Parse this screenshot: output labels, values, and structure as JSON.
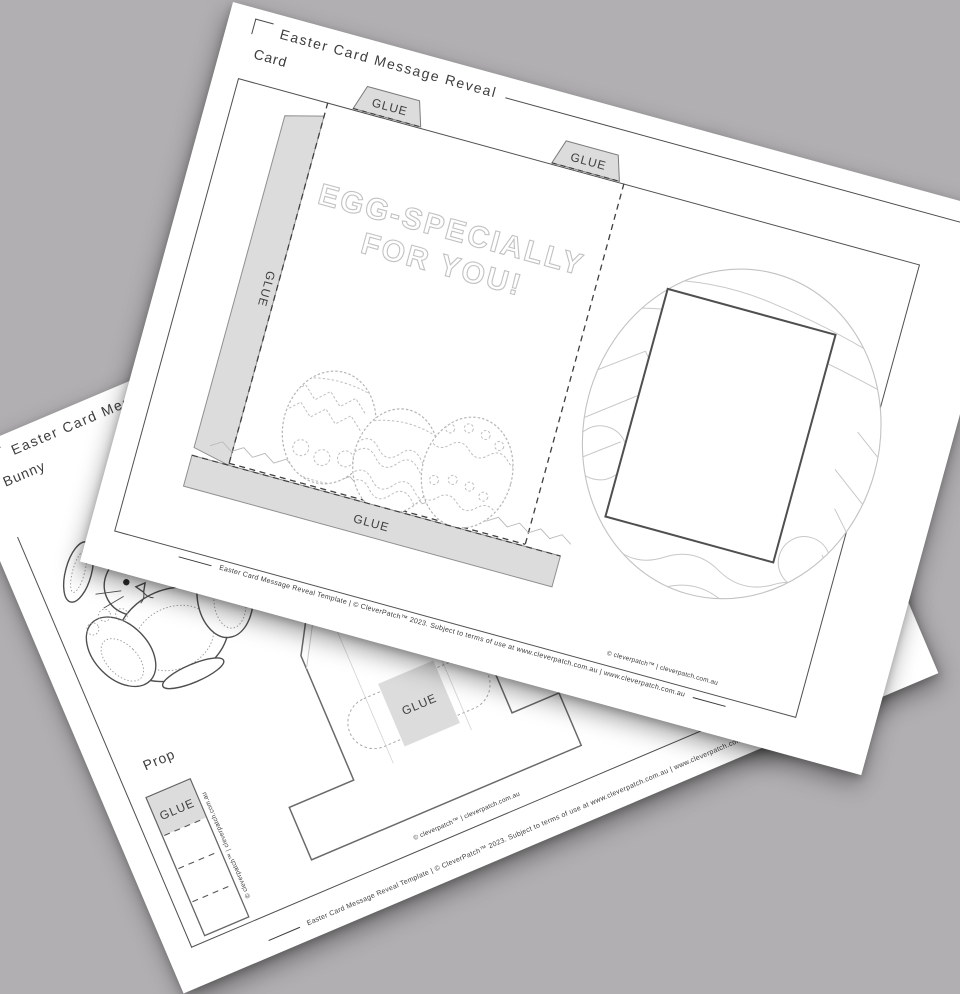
{
  "card_page": {
    "title": "Easter Card Message Reveal",
    "label": "Card",
    "message_line1": "EGG-SPECIALLY",
    "message_line2": "FOR YOU!",
    "glue_labels": {
      "top_left": "GLUE",
      "top_right": "GLUE",
      "left_flap": "GLUE",
      "bottom": "GLUE"
    },
    "credit": "© cleverpatch™ | cleverpatch.com.au",
    "footer": "Easter Card Message Reveal Template  |  © CleverPatch™ 2023. Subject to terms of use at www.cleverpatch.com.au  |  www.cleverpatch.com.au"
  },
  "prop_page": {
    "title": "Easter Card Message Reveal",
    "label_bunny": "Bunny",
    "label_prop": "Prop",
    "glue_labels": {
      "strip": "GLUE",
      "stand": "GLUE"
    },
    "strip_side_credit": "© cleverpatch™ | cleverpatch.com.au",
    "credit": "© cleverpatch™ | cleverpatch.com.au",
    "footer": "Easter Card Message Reveal Template  |  © CleverPatch™ 2023. Subject to terms of use at www.cleverpatch.com.au  |  www.cleverpatch.com.au"
  }
}
